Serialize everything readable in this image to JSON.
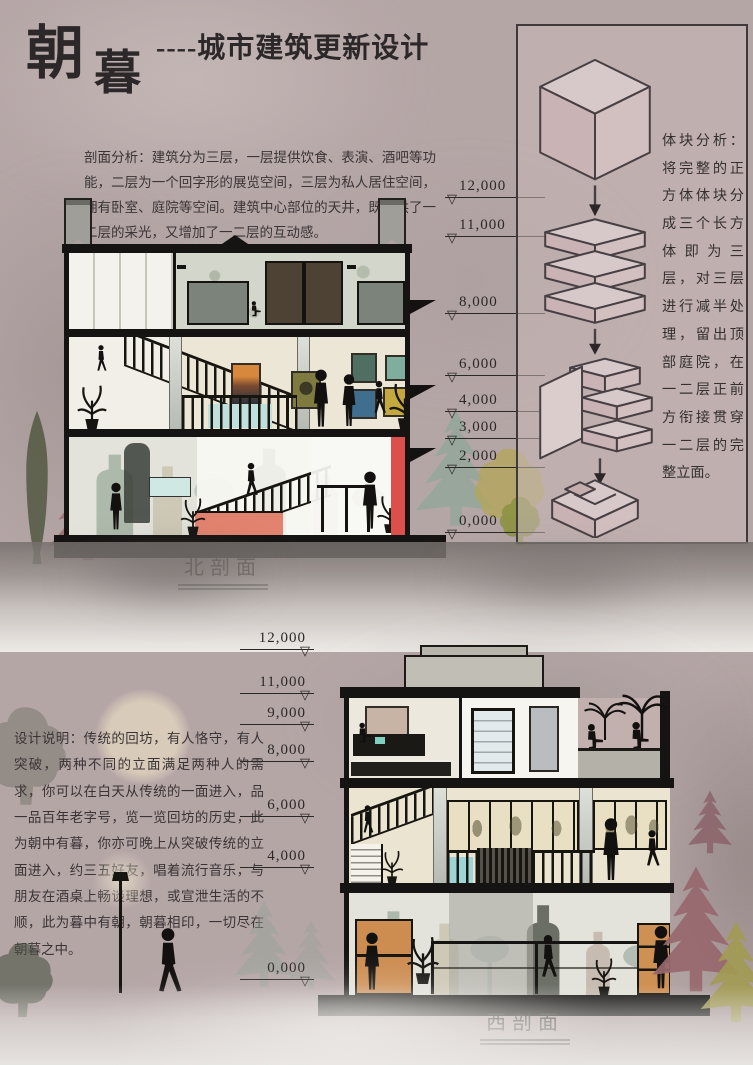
{
  "header": {
    "title_main": "朝",
    "title_sub": "暮",
    "tagline": "----城市建筑更新设计"
  },
  "north": {
    "analysis": "剖面分析：建筑分为三层，一层提供饮食、表演、酒吧等功能，二层为一个回字形的展览空间，三层为私人居住空间，拥有卧室、庭院等空间。建筑中心部位的天井，既提供了一二层的采光，又增加了一二层的互动感。",
    "label": "北剖面",
    "elevations": [
      "12,000",
      "11,000",
      "8,000",
      "6,000",
      "4,000",
      "3,000",
      "2,000",
      "0,000"
    ]
  },
  "massing": {
    "text": "体块分析：将完整的正方体体块分成三个长方体即为三层，对三层进行减半处理，留出顶部庭院，在一二层正前方衔接贯穿一二层的完整立面。"
  },
  "west": {
    "notes": "设计说明：传统的回坊，有人恪守，有人突破，两种不同的立面满足两种人的需求，你可以在白天从传统的一面进入，品一品百年老字号，览一览回坊的历史，此为朝中有暮，你亦可晚上从突破传统的立面进入，约三五好友，唱着流行音乐，与朋友在酒桌上畅谈理想，或宣泄生活的不顺，此为暮中有朝，朝暮相印，一切尽在朝暮之中。",
    "label": "西剖面",
    "elevations": [
      "12,000",
      "11,000",
      "9,000",
      "8,000",
      "6,000",
      "4,000",
      "0,000"
    ]
  },
  "icons": {
    "level_triangle": "▽"
  },
  "colors": {
    "background": "#b5a6a6",
    "accent_red": "#dc4f4a",
    "massing_pink": "#d7c9c9",
    "ink": "#161412"
  }
}
